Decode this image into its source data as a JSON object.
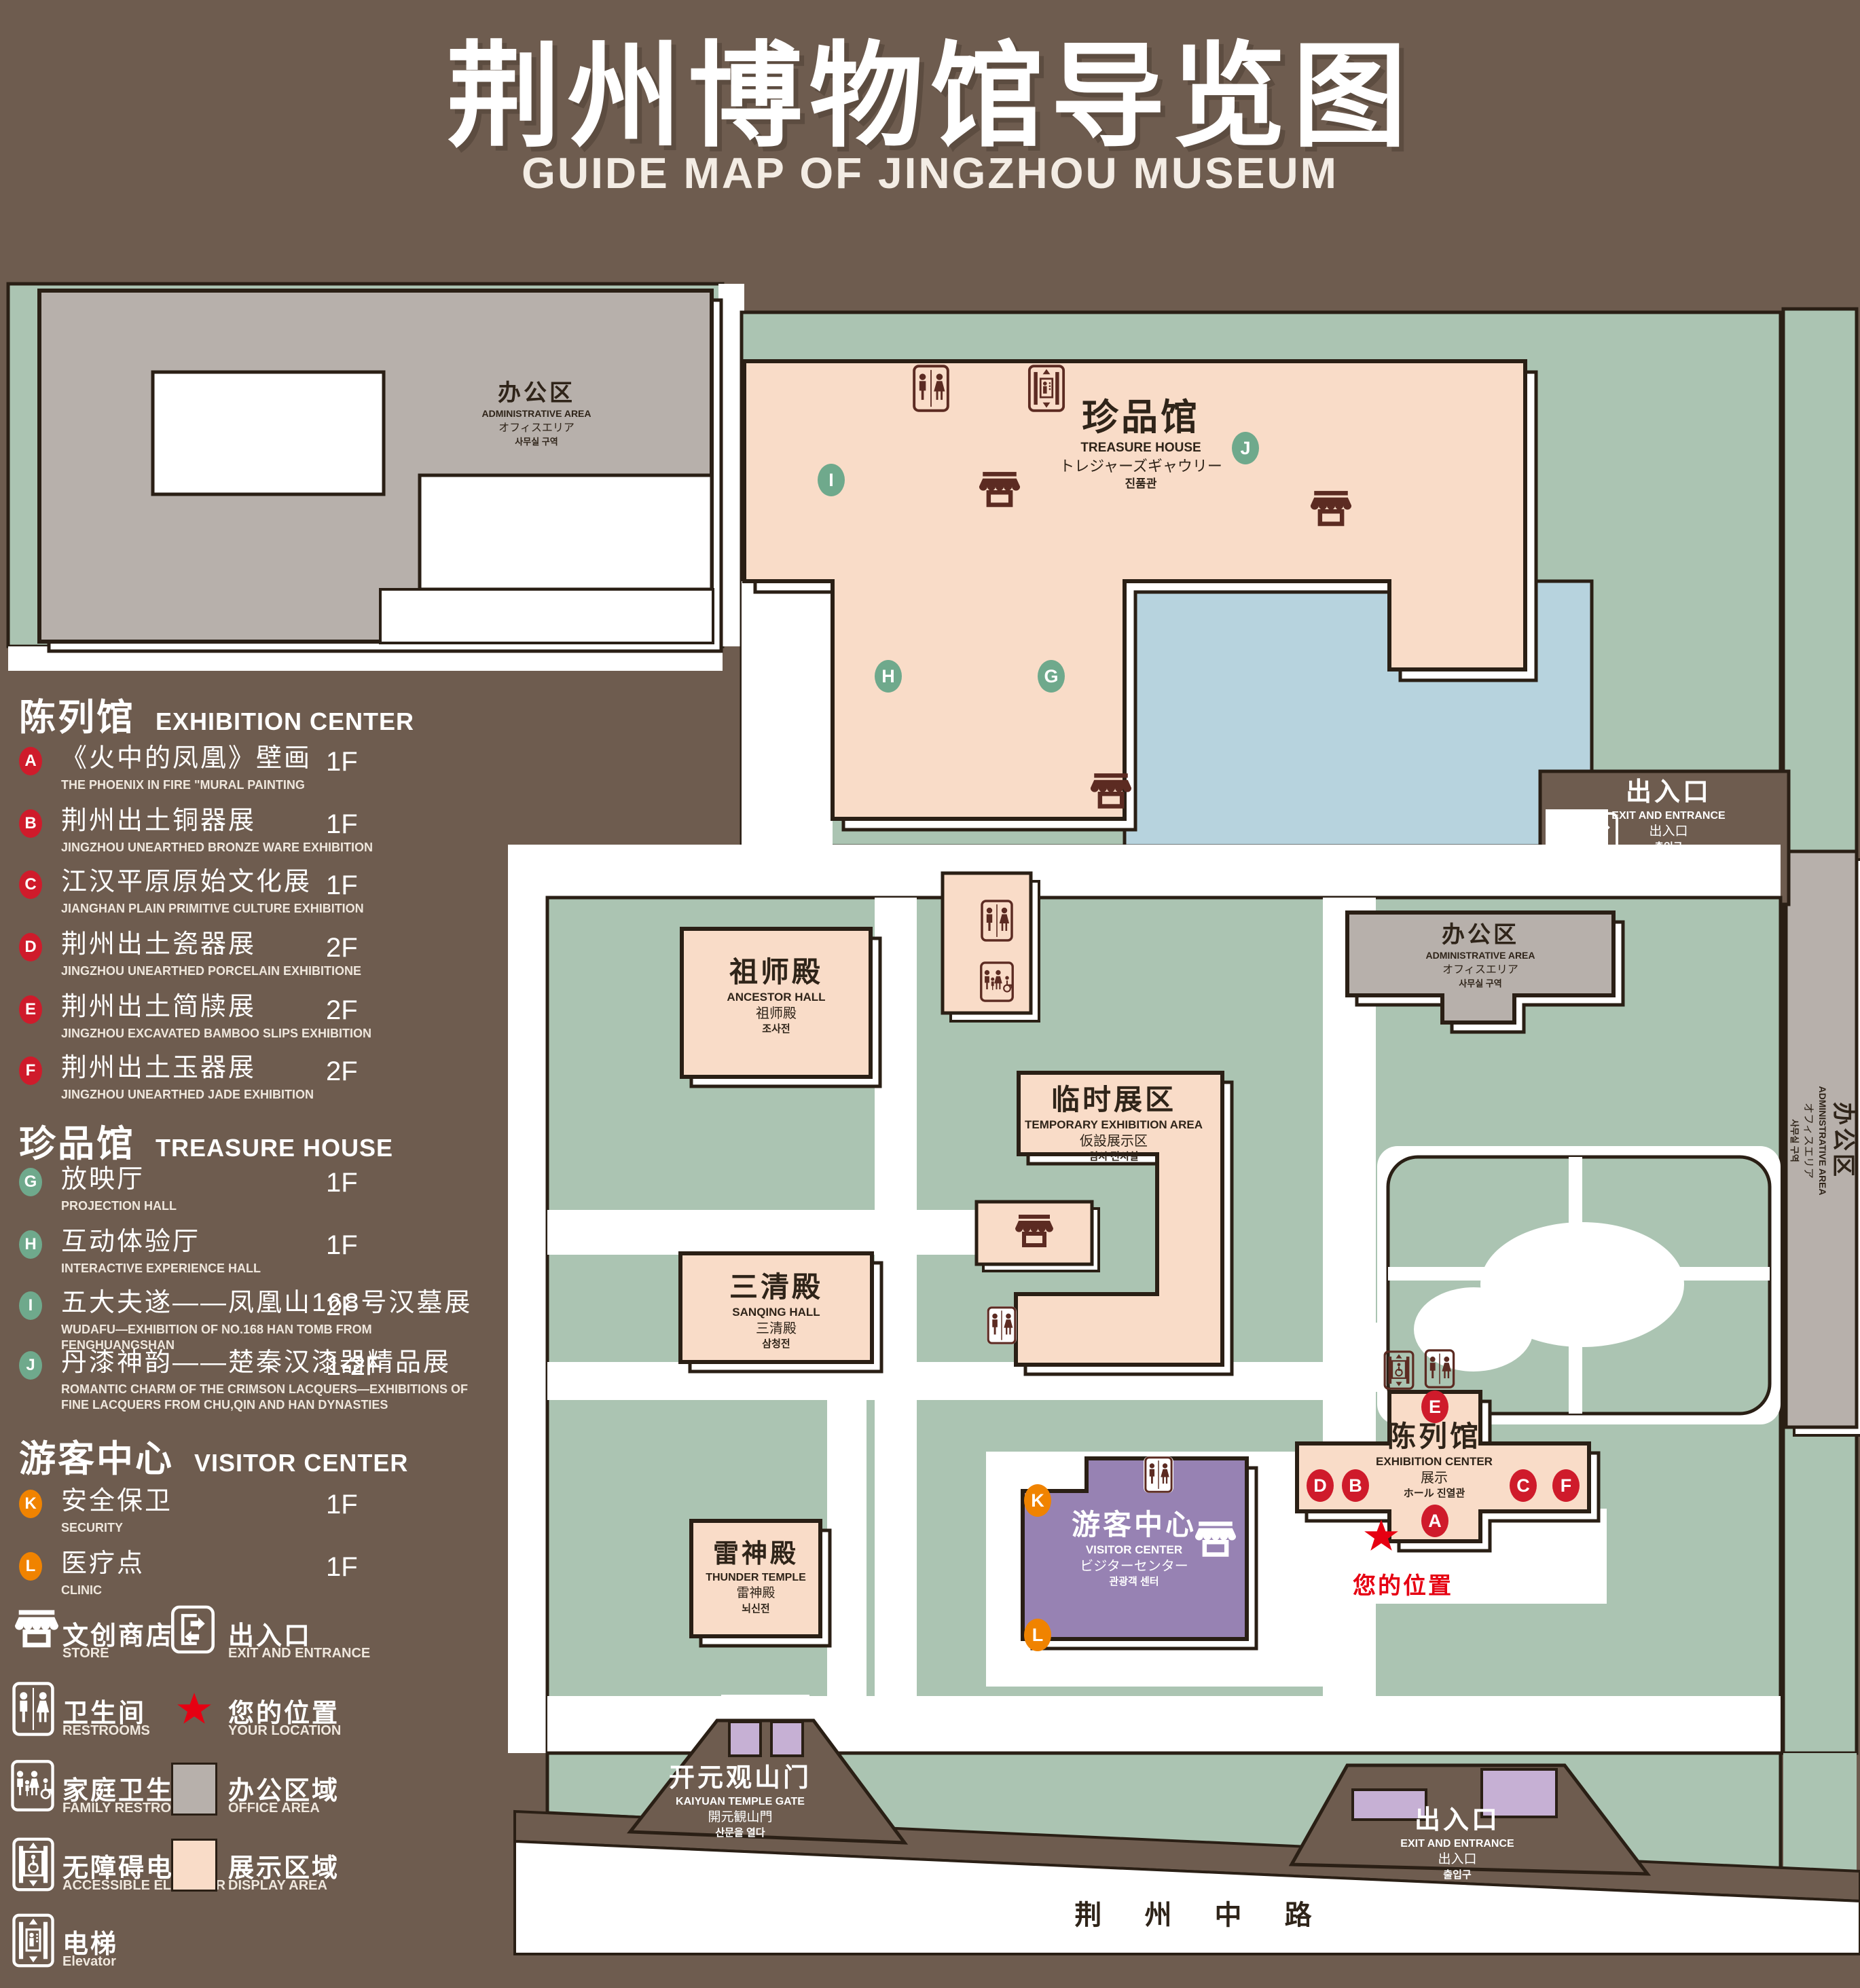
{
  "title": {
    "zh": "荆州博物馆导览图",
    "en": "GUIDE MAP OF JINGZHOU MUSEUM"
  },
  "legend": {
    "sections": [
      {
        "zh": "陈列馆",
        "en": "EXHIBITION CENTER",
        "items": [
          {
            "letter": "A",
            "zh": "《火中的凤凰》壁画",
            "en": "THE PHOENIX IN FIRE \"MURAL PAINTING",
            "floor": "1F"
          },
          {
            "letter": "B",
            "zh": "荆州出土铜器展",
            "en": "JINGZHOU UNEARTHED BRONZE WARE EXHIBITION",
            "floor": "1F"
          },
          {
            "letter": "C",
            "zh": "江汉平原原始文化展",
            "en": "JIANGHAN PLAIN PRIMITIVE CULTURE EXHIBITION",
            "floor": "1F"
          },
          {
            "letter": "D",
            "zh": "荆州出土瓷器展",
            "en": "JINGZHOU UNEARTHED PORCELAIN EXHIBITIONE",
            "floor": "2F"
          },
          {
            "letter": "E",
            "zh": "荆州出土简牍展",
            "en": "JINGZHOU EXCAVATED BAMBOO SLIPS EXHIBITION",
            "floor": "2F"
          },
          {
            "letter": "F",
            "zh": "荆州出土玉器展",
            "en": "JINGZHOU UNEARTHED JADE EXHIBITION",
            "floor": "2F"
          }
        ]
      },
      {
        "zh": "珍品馆",
        "en": "TREASURE HOUSE",
        "items": [
          {
            "letter": "G",
            "zh": "放映厅",
            "en": "PROJECTION HALL",
            "floor": "1F"
          },
          {
            "letter": "H",
            "zh": "互动体验厅",
            "en": "INTERACTIVE EXPERIENCE HALL",
            "floor": "1F"
          },
          {
            "letter": "I",
            "zh": "五大夫遂——凤凰山168号汉墓展",
            "en": "WUDAFU—EXHIBITION OF NO.168 HAN TOMB FROM FENGHUANGSHAN",
            "floor": "2F"
          },
          {
            "letter": "J",
            "zh": "丹漆神韵——楚秦汉漆器精品展",
            "en": "ROMANTIC CHARM OF THE CRIMSON LACQUERS—EXHIBITIONS OF FINE LACQUERS FROM CHU,QIN AND HAN DYNASTIES",
            "floor": "1-2F"
          }
        ]
      },
      {
        "zh": "游客中心",
        "en": "VISITOR CENTER",
        "items": [
          {
            "letter": "K",
            "zh": "安全保卫",
            "en": "SECURITY",
            "floor": "1F"
          },
          {
            "letter": "L",
            "zh": "医疗点",
            "en": "CLINIC",
            "floor": "1F"
          }
        ]
      }
    ],
    "symbols": [
      {
        "zh": "文创商店",
        "en": "STORE",
        "icon": "store-icon"
      },
      {
        "zh": "出入口",
        "en": "EXIT AND ENTRANCE",
        "icon": "exit-icon"
      },
      {
        "zh": "卫生间",
        "en": "RESTROOMS",
        "icon": "restroom-icon"
      },
      {
        "zh": "您的位置",
        "en": "YOUR LOCATION",
        "icon": "location-star-icon"
      },
      {
        "zh": "家庭卫生间",
        "en": "FAMILY RESTROOMS",
        "icon": "family-restroom-icon"
      },
      {
        "zh": "办公区域",
        "en": "OFFICE AREA",
        "icon": "office-area-swatch"
      },
      {
        "zh": "无障碍电梯",
        "en": "ACCESSIBLE ELEVATOR",
        "icon": "accessible-elevator-icon"
      },
      {
        "zh": "展示区域",
        "en": "DISPLAY AREA",
        "icon": "display-area-swatch"
      },
      {
        "zh": "电梯",
        "en": "Elevator",
        "icon": "elevator-icon"
      }
    ]
  },
  "map": {
    "buildings": {
      "admin_top_left": {
        "zh": "办公区",
        "en": "ADMINISTRATIVE AREA",
        "l3": "オフィスエリア",
        "l4": "사무실 구역"
      },
      "treasure_house": {
        "zh": "珍品馆",
        "en": "TREASURE HOUSE",
        "l3": "トレジャーズギャウリー",
        "l4": "진품관"
      },
      "ancestor_hall": {
        "zh": "祖师殿",
        "en": "ANCESTOR HALL",
        "l3": "祖师殿",
        "l4": "조사전"
      },
      "temporary_exhibition": {
        "zh": "临时展区",
        "en": "TEMPORARY EXHIBITION AREA",
        "l3": "仮設展示区",
        "l4": "임시 전시실"
      },
      "admin_center_right": {
        "zh": "办公区",
        "en": "ADMINISTRATIVE AREA",
        "l3": "オフィスエリア",
        "l4": "사무실 구역"
      },
      "admin_east_strip": {
        "zh": "办公区",
        "en": "ADMINISTRATIVE AREA",
        "l3": "オフィスエリア",
        "l4": "사무실 구역"
      },
      "sanqing_hall": {
        "zh": "三清殿",
        "en": "SANQING HALL",
        "l3": "三清殿",
        "l4": "삼청전"
      },
      "thunder_temple": {
        "zh": "雷神殿",
        "en": "THUNDER TEMPLE",
        "l3": "雷神殿",
        "l4": "뇌신전"
      },
      "visitor_center": {
        "zh": "游客中心",
        "en": "VISITOR CENTER",
        "l3": "ビジターセンター",
        "l4": "관광객 센터"
      },
      "exhibition_center": {
        "zh": "陈列馆",
        "en": "EXHIBITION CENTER",
        "l3": "展示",
        "l4": "ホール 진열관"
      }
    },
    "labels": {
      "exit_right": {
        "zh": "出入口",
        "en": "EXIT AND ENTRANCE",
        "l3": "出入口",
        "l4": "출입구"
      },
      "exit_bottom": {
        "zh": "出入口",
        "en": "EXIT AND ENTRANCE",
        "l3": "出入口",
        "l4": "출입구"
      },
      "gate": {
        "zh": "开元观山门",
        "en": "KAIYUAN TEMPLE GATE",
        "l3": "開元観山門",
        "l4": "산문을 열다"
      },
      "road": "荆 州 中 路",
      "your_location": "您的位置"
    },
    "markers": [
      {
        "letter": "A",
        "color": "red"
      },
      {
        "letter": "B",
        "color": "red"
      },
      {
        "letter": "C",
        "color": "red"
      },
      {
        "letter": "D",
        "color": "red"
      },
      {
        "letter": "E",
        "color": "red"
      },
      {
        "letter": "F",
        "color": "red"
      },
      {
        "letter": "G",
        "color": "green"
      },
      {
        "letter": "H",
        "color": "green"
      },
      {
        "letter": "I",
        "color": "green"
      },
      {
        "letter": "J",
        "color": "green"
      },
      {
        "letter": "K",
        "color": "orange"
      },
      {
        "letter": "L",
        "color": "orange"
      }
    ]
  },
  "colors": {
    "background": "#6e5c4f",
    "green_area": "#abc4b2",
    "display_area": "#f9dcc8",
    "office_area": "#b7b0ab",
    "lake": "#b7d3de",
    "visitor_center": "#9782b3",
    "gate_building": "#c6b0d4",
    "outline": "#2a1f15",
    "marker_red": "#cf1b2b",
    "marker_green": "#6fa98c",
    "marker_orange": "#f08300",
    "icon_brown": "#5c2b22",
    "location_red": "#e60012"
  }
}
